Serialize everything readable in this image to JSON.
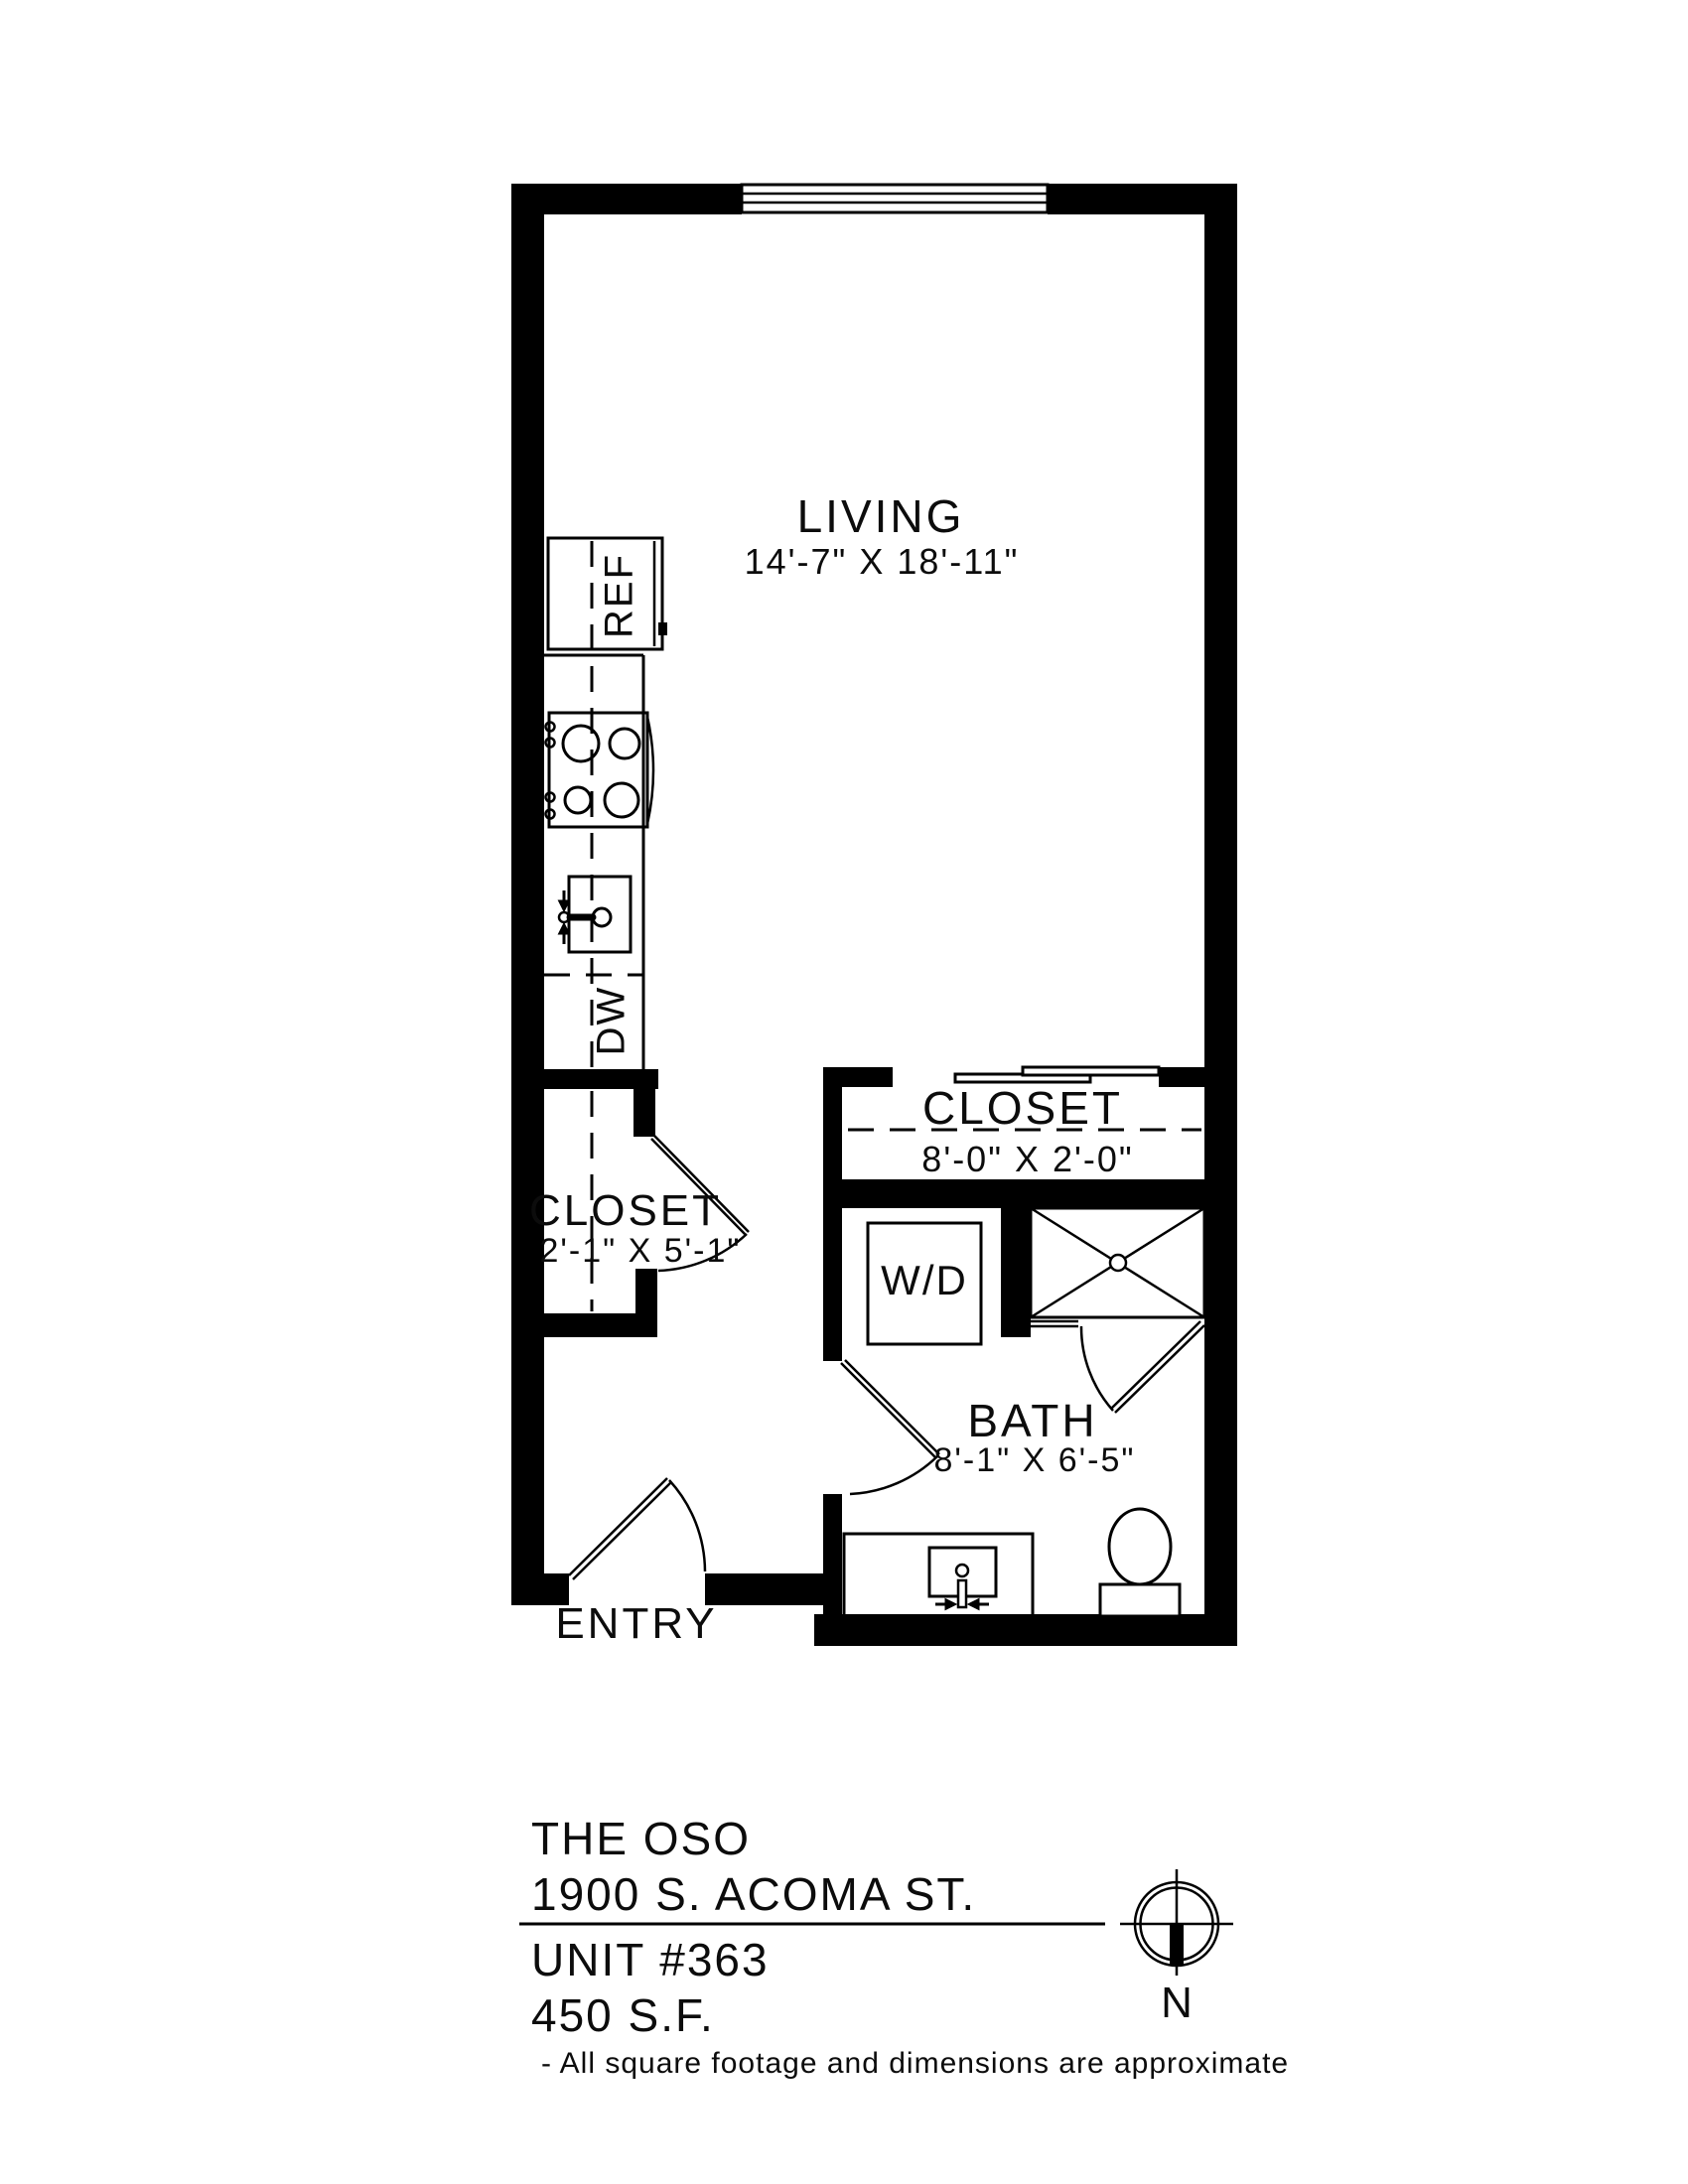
{
  "page": {
    "background": "#ffffff",
    "ink": "#000000"
  },
  "plan": {
    "rooms": {
      "living": {
        "name": "LIVING",
        "dims": "14'-7\" X 18'-11\""
      },
      "closet_right": {
        "name": "CLOSET",
        "dims": "8'-0\" X 2'-0\""
      },
      "closet_left": {
        "name": "CLOSET",
        "dims": "2'-1\" X 5'-1\""
      },
      "bath": {
        "name": "BATH",
        "dims": "8'-1\" X 6'-5\""
      },
      "entry": {
        "name": "ENTRY"
      }
    },
    "appliances": {
      "refrigerator": "REF",
      "dishwasher": "DW",
      "washer_dryer": "W/D"
    }
  },
  "title_block": {
    "building": "THE OSO",
    "address": "1900 S. ACOMA ST.",
    "unit": "UNIT #363",
    "area": "450 S.F.",
    "note": "- All square footage and dimensions are approximate"
  },
  "compass": {
    "label": "N"
  }
}
